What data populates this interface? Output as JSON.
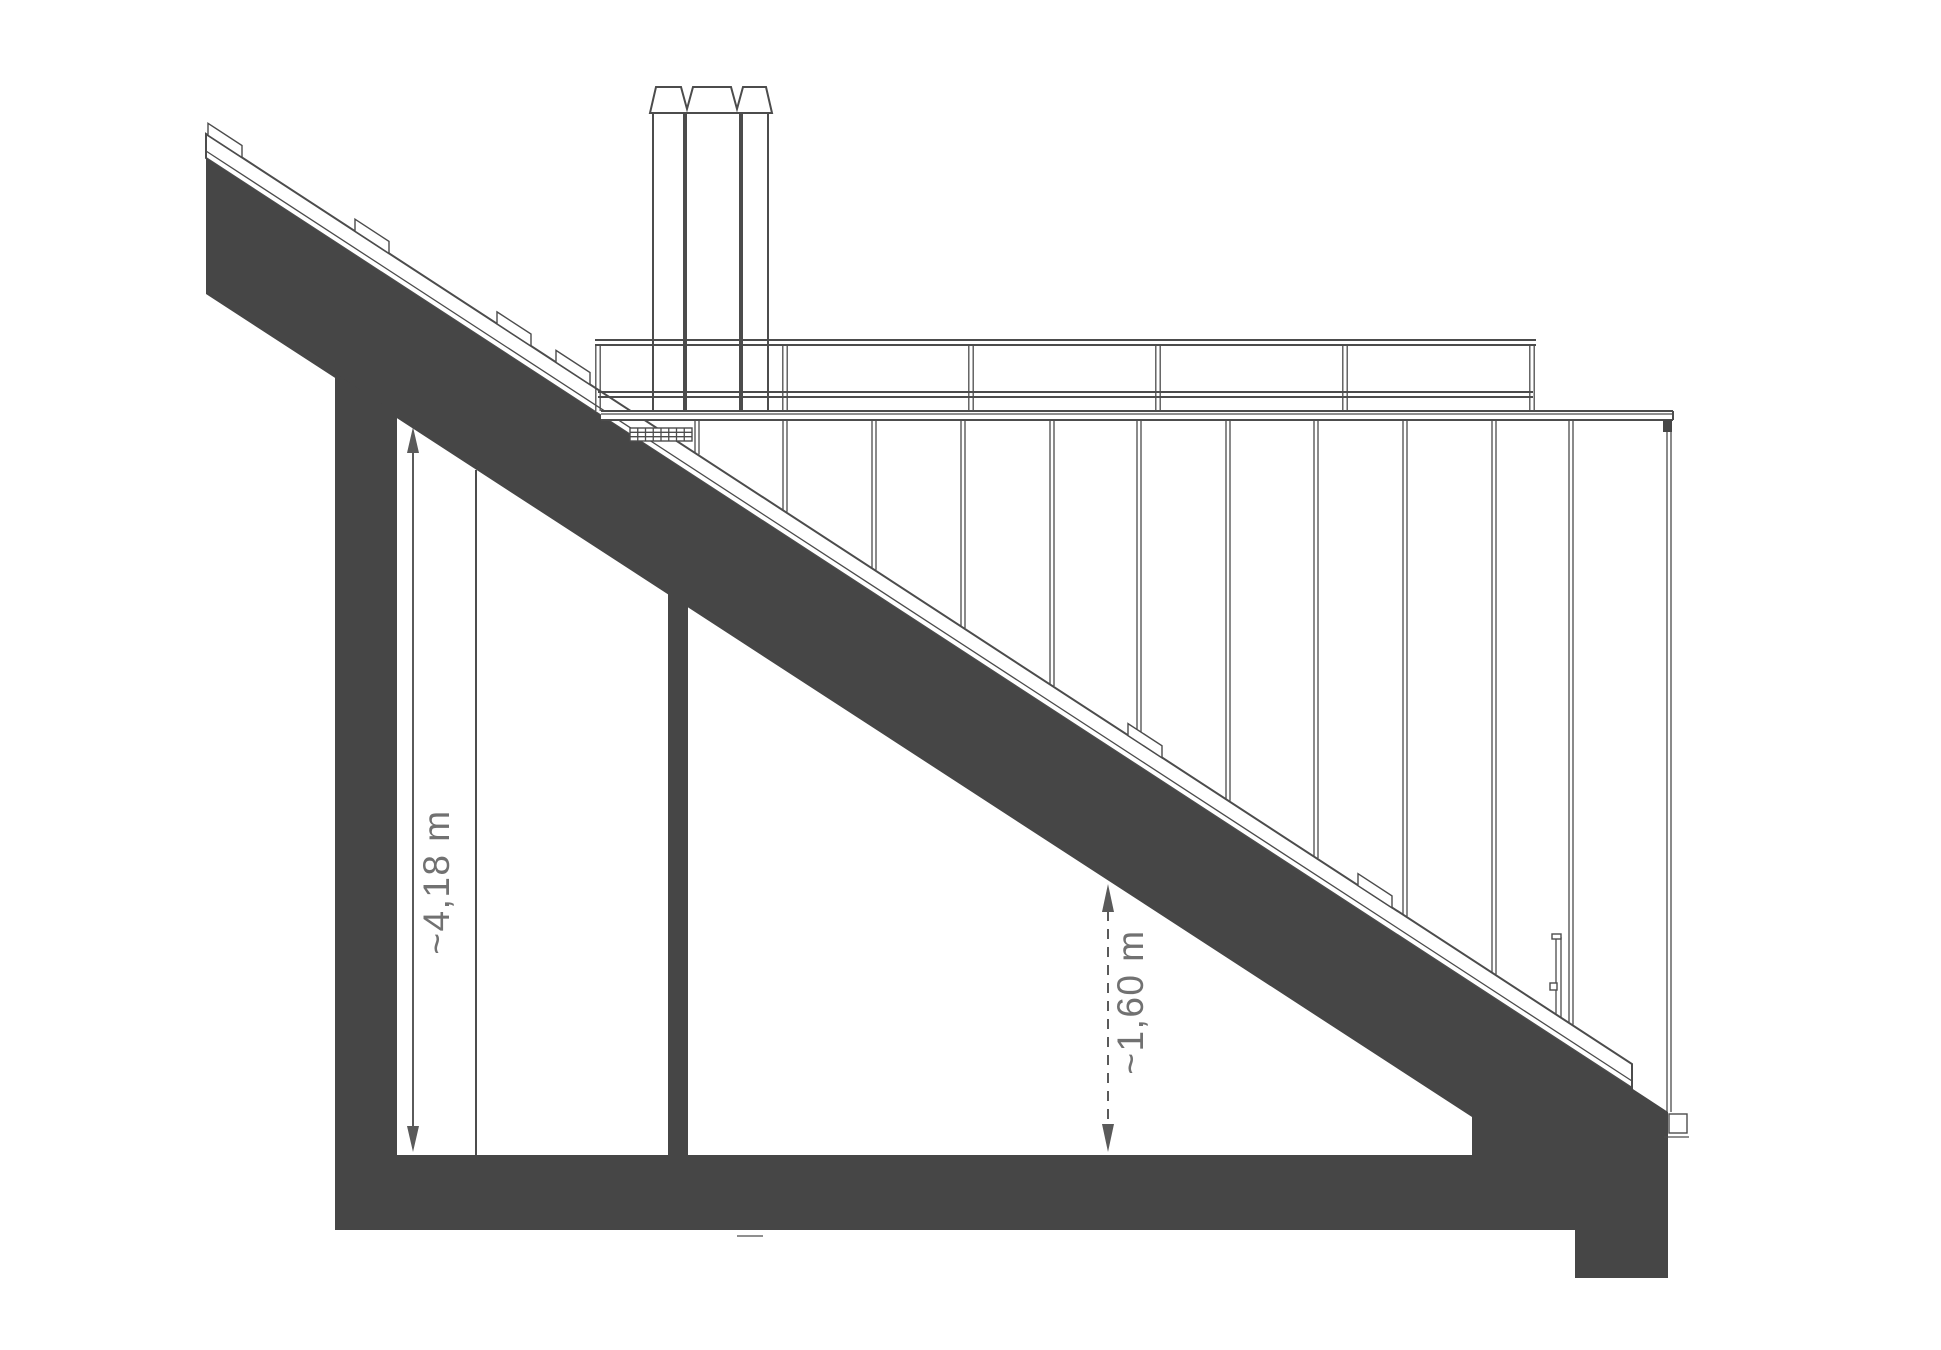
{
  "colors": {
    "poche": "#464646",
    "line": "#4c4c4c",
    "dim": "#5a5a5a",
    "text": "#717171",
    "background": "#ffffff"
  },
  "annotations": {
    "height_left": {
      "label": "~4,18 m"
    },
    "clearance_middle": {
      "label": "~1,60 m"
    }
  },
  "structure": {
    "railing_post_count": 6,
    "facade_panel_joint_count": 11,
    "chimney_flue_count": 3,
    "roof_batten_count": 6,
    "grille_column_count": 8,
    "grille_row_count": 3
  }
}
